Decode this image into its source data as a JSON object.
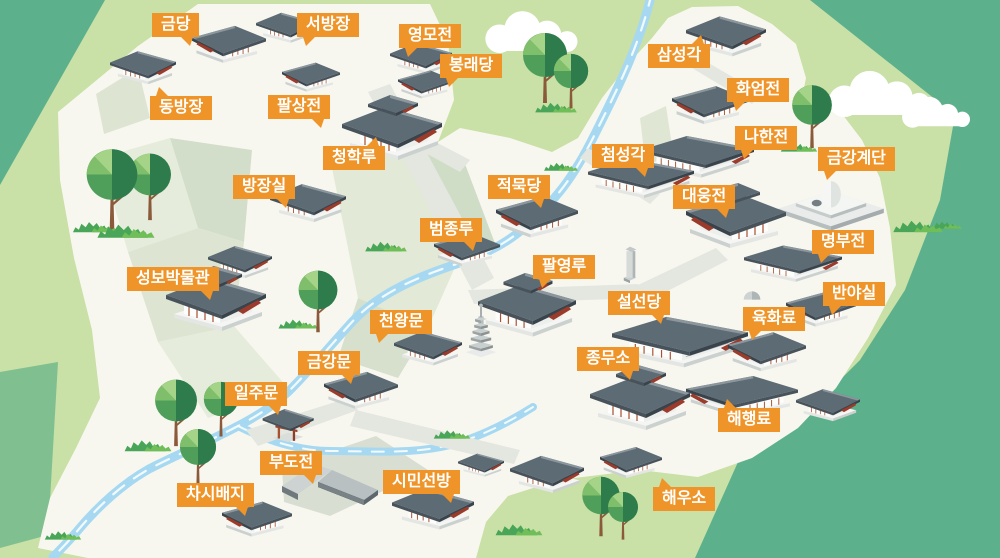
{
  "map": {
    "kind": "illustrated-temple-complex-map",
    "colors": {
      "outer_green": "#5CB18C",
      "valley_green": "#C9E0A6",
      "hill_band_green": "#7FBF90",
      "ground_cream": "#F8F7EF",
      "cliff_light": "#E6ECDB",
      "cliff_mid": "#D2DEC9",
      "path_gray": "#E3E7DF",
      "river_blue": "#A6D9F1",
      "label_bg": "#EE9428",
      "label_text": "#FFFFFF",
      "roof_gray": "#5D6B74",
      "roof_accent_red": "#9A3B2B",
      "wall_white": "#FFFFFF",
      "tree_green": "#4F9F5B",
      "tree_dark_green": "#2E7C4B",
      "trunk_brown": "#8A5A3B"
    },
    "labels": [
      {
        "id": "geumdang",
        "text": "금당",
        "x": 152,
        "y": 13,
        "tail": "br"
      },
      {
        "id": "seobangjang",
        "text": "서방장",
        "x": 297,
        "y": 13,
        "tail": "bl"
      },
      {
        "id": "yeongmojeon",
        "text": "영모전",
        "x": 399,
        "y": 24,
        "tail": "bl"
      },
      {
        "id": "bongnaedang",
        "text": "봉래당",
        "x": 440,
        "y": 54,
        "tail": "bl"
      },
      {
        "id": "samseonggak",
        "text": "삼성각",
        "x": 648,
        "y": 44,
        "tail": "tr"
      },
      {
        "id": "hwaeomjeon",
        "text": "화엄전",
        "x": 727,
        "y": 78,
        "tail": "bl"
      },
      {
        "id": "dongbangjang",
        "text": "동방장",
        "x": 150,
        "y": 96,
        "tail": "tl"
      },
      {
        "id": "palsangjeon",
        "text": "팔상전",
        "x": 268,
        "y": 95,
        "tail": "br"
      },
      {
        "id": "nahanjeon",
        "text": "나한전",
        "x": 735,
        "y": 126,
        "tail": "bl"
      },
      {
        "id": "cheonghangnu",
        "text": "청학루",
        "x": 323,
        "y": 146,
        "tail": "tr"
      },
      {
        "id": "cheomseonggak",
        "text": "첨성각",
        "x": 592,
        "y": 144,
        "tail": "br"
      },
      {
        "id": "geumganggyedan",
        "text": "금강계단",
        "x": 818,
        "y": 147,
        "tail": "bl"
      },
      {
        "id": "bangjangsil",
        "text": "방장실",
        "x": 233,
        "y": 175,
        "tail": "br"
      },
      {
        "id": "jeongmukdang",
        "text": "적묵당",
        "x": 488,
        "y": 175,
        "tail": "br"
      },
      {
        "id": "daeungjeon",
        "text": "대웅전",
        "x": 673,
        "y": 185,
        "tail": "br"
      },
      {
        "id": "beomjongnu",
        "text": "범종루",
        "x": 420,
        "y": 218,
        "tail": "br"
      },
      {
        "id": "myeongbujeon",
        "text": "명부전",
        "x": 812,
        "y": 230,
        "tail": "bl"
      },
      {
        "id": "paryeongnu",
        "text": "팔영루",
        "x": 533,
        "y": 255,
        "tail": "bl"
      },
      {
        "id": "seongbobangmulgwan",
        "text": "성보박물관",
        "x": 127,
        "y": 267,
        "tail": "br"
      },
      {
        "id": "banyasil",
        "text": "반야실",
        "x": 823,
        "y": 282,
        "tail": "bl"
      },
      {
        "id": "seolseondang",
        "text": "설선당",
        "x": 608,
        "y": 291,
        "tail": "br"
      },
      {
        "id": "yukhwaryo",
        "text": "육화료",
        "x": 743,
        "y": 307,
        "tail": "bl"
      },
      {
        "id": "cheonwangmun",
        "text": "천왕문",
        "x": 370,
        "y": 310,
        "tail": "bl"
      },
      {
        "id": "geumgangmun",
        "text": "금강문",
        "x": 298,
        "y": 351,
        "tail": "br"
      },
      {
        "id": "jongmuso",
        "text": "종무소",
        "x": 577,
        "y": 347,
        "tail": "br"
      },
      {
        "id": "iljumun",
        "text": "일주문",
        "x": 225,
        "y": 382,
        "tail": "br"
      },
      {
        "id": "haehaengnyo",
        "text": "해행료",
        "x": 718,
        "y": 408,
        "tail": "tl"
      },
      {
        "id": "budojeon",
        "text": "부도전",
        "x": 260,
        "y": 451,
        "tail": "br"
      },
      {
        "id": "siminseonbang",
        "text": "시민선방",
        "x": 383,
        "y": 470,
        "tail": "br"
      },
      {
        "id": "chasibaeji",
        "text": "차시배지",
        "x": 177,
        "y": 483,
        "tail": "br"
      },
      {
        "id": "haeuso",
        "text": "해우소",
        "x": 653,
        "y": 487,
        "tail": "tl"
      }
    ],
    "buildings": [
      {
        "type": "hall",
        "x": 110,
        "y": 46,
        "w": 66,
        "flip": false
      },
      {
        "type": "hall",
        "x": 192,
        "y": 20,
        "w": 74,
        "flip": true
      },
      {
        "type": "hall",
        "x": 256,
        "y": 8,
        "w": 60,
        "flip": false
      },
      {
        "type": "hall",
        "x": 282,
        "y": 58,
        "w": 58,
        "flip": true
      },
      {
        "type": "hall",
        "x": 390,
        "y": 38,
        "w": 62,
        "flip": false
      },
      {
        "type": "hall",
        "x": 398,
        "y": 66,
        "w": 56,
        "flip": true
      },
      {
        "type": "bighall",
        "x": 342,
        "y": 92,
        "w": 100,
        "flip": false
      },
      {
        "type": "hall",
        "x": 686,
        "y": 10,
        "w": 80,
        "flip": false
      },
      {
        "type": "hall",
        "x": 672,
        "y": 80,
        "w": 76,
        "flip": true
      },
      {
        "type": "longhall",
        "x": 642,
        "y": 132,
        "w": 112,
        "flip": false
      },
      {
        "type": "longhall",
        "x": 588,
        "y": 155,
        "w": 106,
        "flip": false
      },
      {
        "type": "hall",
        "x": 270,
        "y": 178,
        "w": 76,
        "flip": false
      },
      {
        "type": "hall",
        "x": 496,
        "y": 190,
        "w": 82,
        "flip": true
      },
      {
        "type": "bighall",
        "x": 686,
        "y": 180,
        "w": 100,
        "flip": true
      },
      {
        "type": "stupa",
        "x": 776,
        "y": 158,
        "w": 110,
        "flip": false
      },
      {
        "type": "longhall",
        "x": 744,
        "y": 242,
        "w": 98,
        "flip": false
      },
      {
        "type": "hall",
        "x": 786,
        "y": 286,
        "w": 70,
        "flip": true
      },
      {
        "type": "hall",
        "x": 728,
        "y": 326,
        "w": 78,
        "flip": true
      },
      {
        "type": "hall",
        "x": 434,
        "y": 228,
        "w": 66,
        "flip": true
      },
      {
        "type": "hall",
        "x": 208,
        "y": 241,
        "w": 64,
        "flip": false
      },
      {
        "type": "bighall",
        "x": 166,
        "y": 263,
        "w": 100,
        "flip": false
      },
      {
        "type": "bighall",
        "x": 478,
        "y": 270,
        "w": 98,
        "flip": false
      },
      {
        "type": "pagoda",
        "x": 464,
        "y": 296,
        "w": 34,
        "flip": false
      },
      {
        "type": "longhall",
        "x": 612,
        "y": 312,
        "w": 136,
        "flip": false
      },
      {
        "type": "stele",
        "x": 622,
        "y": 244,
        "w": 16,
        "flip": false
      },
      {
        "type": "stone",
        "x": 742,
        "y": 288,
        "w": 20,
        "flip": false
      },
      {
        "type": "bighall",
        "x": 590,
        "y": 362,
        "w": 100,
        "flip": false
      },
      {
        "type": "longhall",
        "x": 686,
        "y": 372,
        "w": 112,
        "flip": true
      },
      {
        "type": "hall",
        "x": 796,
        "y": 384,
        "w": 64,
        "flip": false
      },
      {
        "type": "hall",
        "x": 394,
        "y": 326,
        "w": 68,
        "flip": false
      },
      {
        "type": "hall",
        "x": 324,
        "y": 366,
        "w": 74,
        "flip": true
      },
      {
        "type": "gate",
        "x": 258,
        "y": 402,
        "w": 58,
        "flip": false
      },
      {
        "type": "walls",
        "x": 280,
        "y": 462,
        "w": 100,
        "flip": false
      },
      {
        "type": "hall",
        "x": 222,
        "y": 496,
        "w": 70,
        "flip": true
      },
      {
        "type": "hall",
        "x": 392,
        "y": 482,
        "w": 82,
        "flip": false
      },
      {
        "type": "hall",
        "x": 458,
        "y": 450,
        "w": 46,
        "flip": false
      },
      {
        "type": "hall",
        "x": 510,
        "y": 450,
        "w": 74,
        "flip": false
      },
      {
        "type": "hall",
        "x": 600,
        "y": 442,
        "w": 62,
        "flip": true
      }
    ],
    "trees": [
      {
        "x": 112,
        "y": 232,
        "s": 1.15
      },
      {
        "x": 150,
        "y": 222,
        "s": 0.95
      },
      {
        "x": 545,
        "y": 105,
        "s": 1.0
      },
      {
        "x": 571,
        "y": 110,
        "s": 0.78
      },
      {
        "x": 812,
        "y": 150,
        "s": 0.9
      },
      {
        "x": 318,
        "y": 334,
        "s": 0.88
      },
      {
        "x": 176,
        "y": 448,
        "s": 0.95
      },
      {
        "x": 221,
        "y": 438,
        "s": 0.78
      },
      {
        "x": 198,
        "y": 488,
        "s": 0.82
      },
      {
        "x": 601,
        "y": 538,
        "s": 0.85
      },
      {
        "x": 623,
        "y": 541,
        "s": 0.68
      }
    ],
    "bushes": [
      {
        "x": 126,
        "y": 240,
        "s": 1.1
      },
      {
        "x": 95,
        "y": 234,
        "s": 0.85
      },
      {
        "x": 556,
        "y": 114,
        "s": 0.8
      },
      {
        "x": 799,
        "y": 153,
        "s": 0.7
      },
      {
        "x": 386,
        "y": 253,
        "s": 0.8
      },
      {
        "x": 561,
        "y": 172,
        "s": 0.65
      },
      {
        "x": 918,
        "y": 234,
        "s": 0.95
      },
      {
        "x": 946,
        "y": 230,
        "s": 0.6
      },
      {
        "x": 148,
        "y": 453,
        "s": 0.9
      },
      {
        "x": 519,
        "y": 537,
        "s": 0.9
      },
      {
        "x": 63,
        "y": 541,
        "s": 0.7
      },
      {
        "x": 298,
        "y": 330,
        "s": 0.75
      },
      {
        "x": 452,
        "y": 440,
        "s": 0.7
      }
    ],
    "clouds": [
      {
        "x": 530,
        "y": 33,
        "s": 0.95
      },
      {
        "x": 878,
        "y": 95,
        "s": 1.05
      },
      {
        "x": 935,
        "y": 113,
        "s": 0.7
      }
    ]
  }
}
